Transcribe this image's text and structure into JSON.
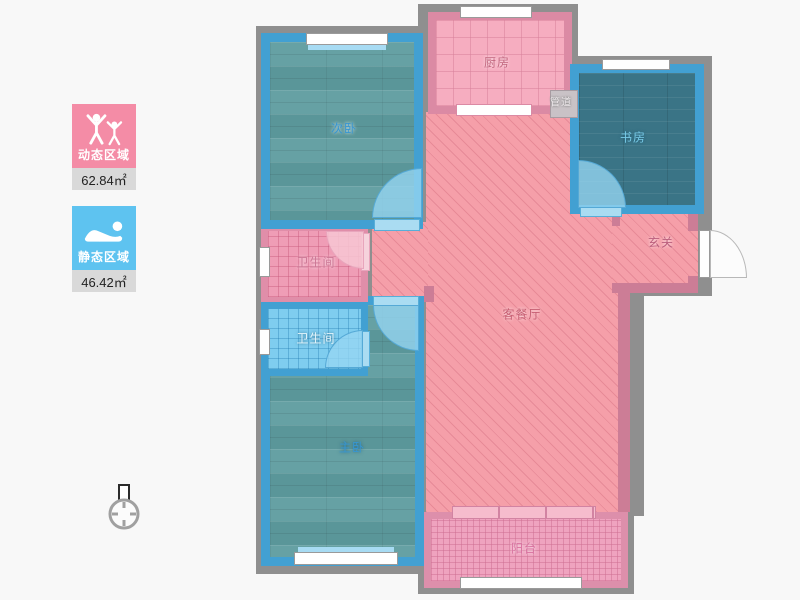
{
  "legend": {
    "dynamic_area": {
      "label": "动态区域",
      "value": "62.84㎡"
    },
    "static_area": {
      "label": "静态区域",
      "value": "46.42㎡"
    }
  },
  "floorplan": {
    "rooms": {
      "secondary_bedroom": {
        "label": "次卧"
      },
      "kitchen": {
        "label": "厨房"
      },
      "duct": {
        "label": "管道"
      },
      "study": {
        "label": "书房"
      },
      "foyer": {
        "label": "玄关"
      },
      "bathroom_upper": {
        "label": "卫生间"
      },
      "bathroom_lower": {
        "label": "卫生间"
      },
      "living_dining": {
        "label": "客餐厅"
      },
      "master_bedroom": {
        "label": "主卧"
      },
      "balcony": {
        "label": "阳台"
      }
    },
    "colors": {
      "dynamic_accent": "#f48ca6",
      "static_accent": "#5ec3f0",
      "bedroom_wall_blue": "#42a0d2",
      "pink_wall": "#db8aa4",
      "gray_wall": "#8f8f8f",
      "wood_floor_teal": "#5e9c9f",
      "study_floor_teal": "#3a7486",
      "living_hatch_pink": "#f59fa9"
    }
  }
}
